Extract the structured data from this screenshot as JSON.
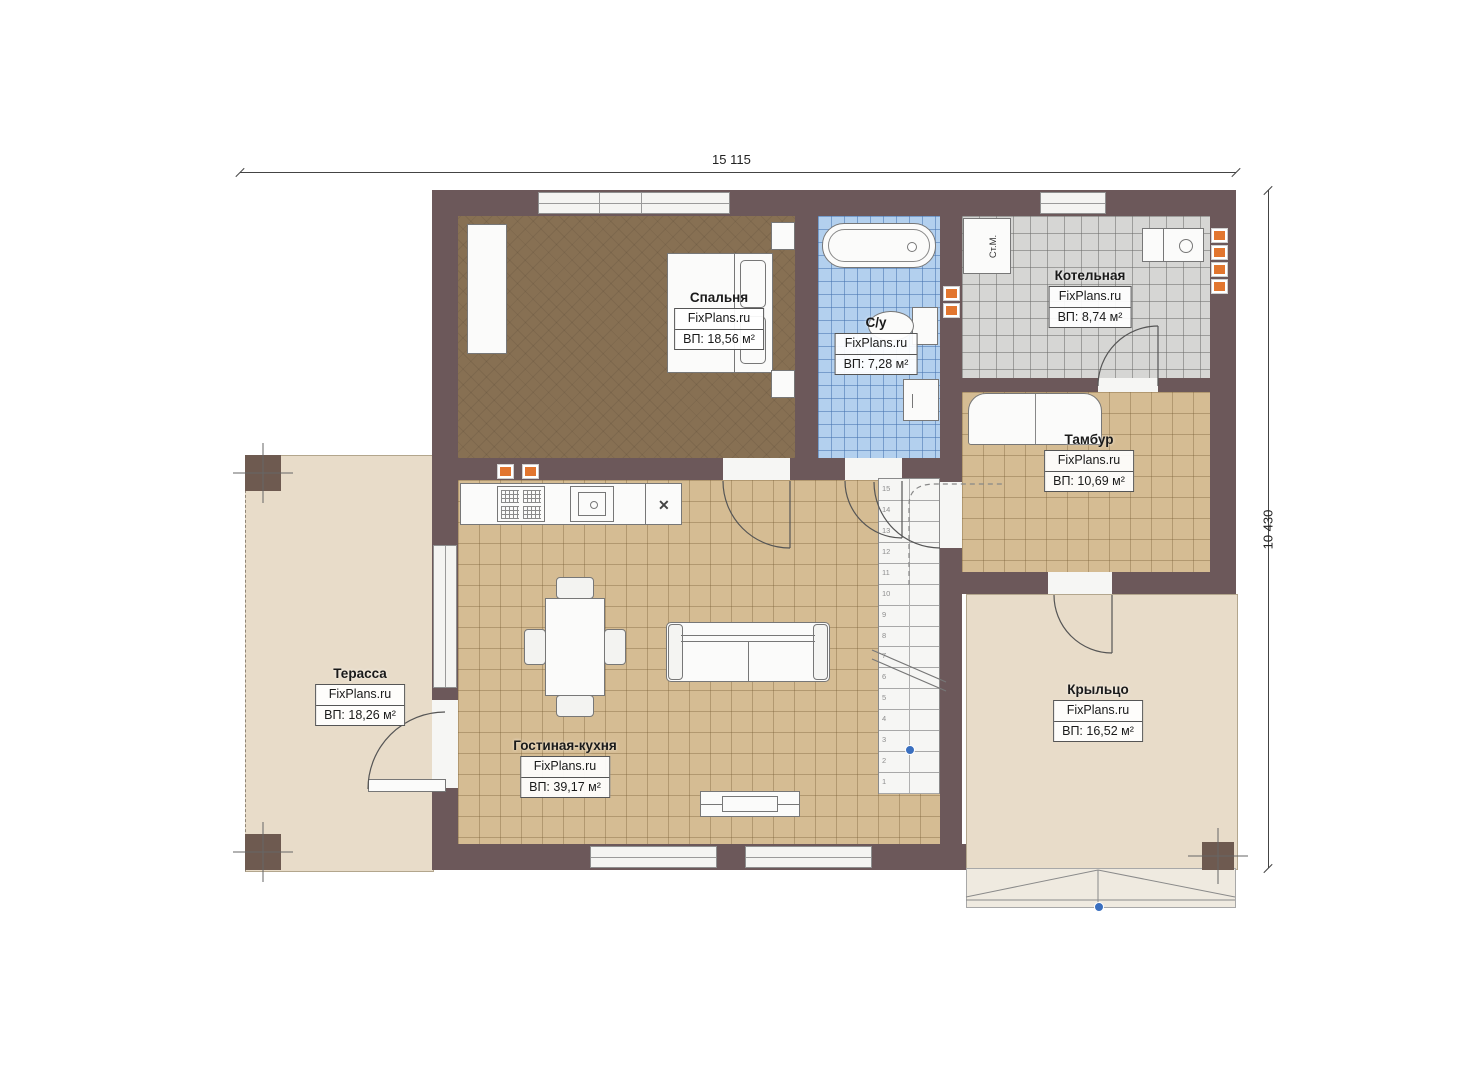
{
  "dimensions": {
    "top": "15 115",
    "right": "10 430"
  },
  "rooms": {
    "bedroom": {
      "name": "Спальня",
      "brand": "FixPlans.ru",
      "area": "ВП: 18,56 м²"
    },
    "bathroom": {
      "name": "С/у",
      "brand": "FixPlans.ru",
      "area": "ВП: 7,28 м²"
    },
    "boiler": {
      "name": "Котельная",
      "brand": "FixPlans.ru",
      "area": "ВП: 8,74 м²"
    },
    "vestibule": {
      "name": "Тамбур",
      "brand": "FixPlans.ru",
      "area": "ВП: 10,69 м²"
    },
    "terrace": {
      "name": "Терасса",
      "brand": "FixPlans.ru",
      "area": "ВП: 18,26 м²"
    },
    "living_kitchen": {
      "name": "Гостиная-кухня",
      "brand": "FixPlans.ru",
      "area": "ВП: 39,17 м²"
    },
    "porch": {
      "name": "Крыльцо",
      "brand": "FixPlans.ru",
      "area": "ВП: 16,52 м²"
    }
  },
  "annotations": {
    "washing_machine": "Ст.М.",
    "kitchen_unit_mark": "✕"
  },
  "stairs": {
    "step_count": 15
  },
  "colors": {
    "wall": "#6c585a",
    "floor_carpet": "#877053",
    "floor_tile_blue": "#b3d0ee",
    "floor_tile_gray": "#d6d6d4",
    "floor_tile_tan": "#d5bc93",
    "floor_beige": "#e8dcc9",
    "vent_orange": "#e2762f",
    "marker_blue": "#3a6fbf"
  }
}
